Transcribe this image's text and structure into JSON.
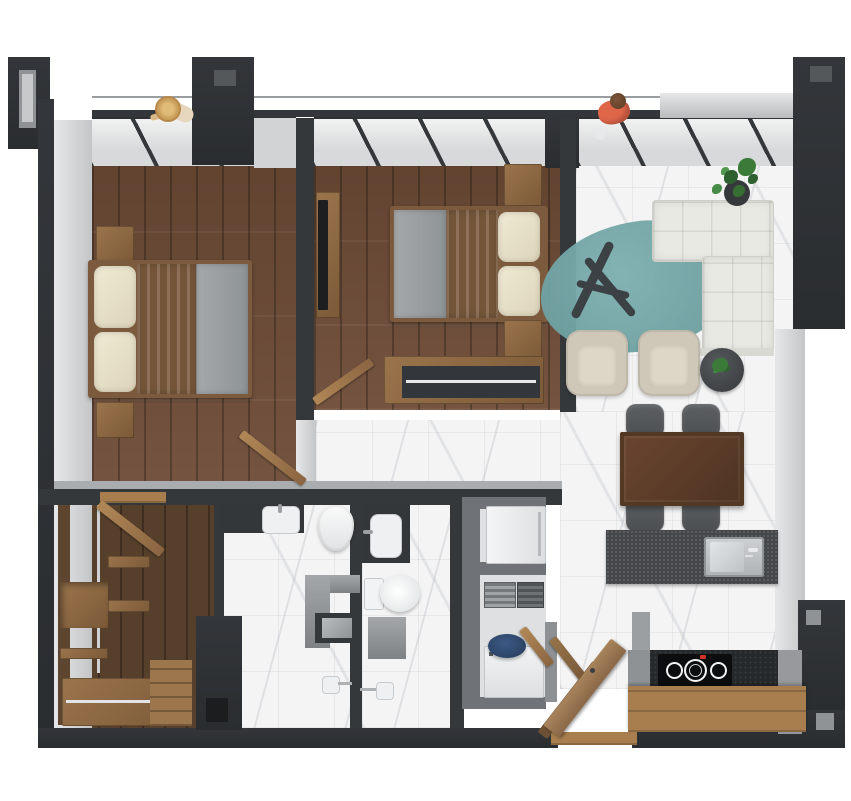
{
  "scene": {
    "title": "3D top-down floor plan render of a two-bedroom apartment",
    "view": "top-down axonometric render",
    "background": "#ffffff"
  },
  "palette": {
    "wall_dark": "#2e3134",
    "wall_interior": "#35383b",
    "wall_face_gray": "#c3c5c7",
    "wood_floor": "#6d4b36",
    "wood_furniture": "#9a744c",
    "marble_tile": "#f4f4f5",
    "sofa_white": "#e9e9e4",
    "rug_teal": "#6fa2a4",
    "blanket_blue": "#8ba0b2",
    "pillow_cream": "#ece5cf",
    "mattress_gray": "#9aa0a2",
    "dining_table_wood": "#5b3d2a",
    "chair_gray": "#55585b",
    "island_counter": "#45484b",
    "steel_sink": "#c0c4c6",
    "cooktop_black": "#0c0d0e",
    "cooktop_indicator_red": "#d23327",
    "appliance_white": "#eef0f1",
    "washer_basket_blue": "#31486b",
    "plant_green": "#3c7a3a",
    "person_shirt_orange": "#e0664a",
    "person_hat_straw": "#caa05c"
  },
  "rooms": [
    {
      "name": "bedroom-1",
      "floor": "wood planks"
    },
    {
      "name": "bedroom-2",
      "floor": "wood planks"
    },
    {
      "name": "living-dining-room",
      "floor": "white marble tile"
    },
    {
      "name": "kitchen",
      "floor": "white marble tile"
    },
    {
      "name": "bathroom-1",
      "floor": "white marble tile"
    },
    {
      "name": "bathroom-2",
      "floor": "white marble tile"
    },
    {
      "name": "walk-in-closet",
      "floor": "wood planks"
    },
    {
      "name": "utility-laundry-closet",
      "floor": "gray tile"
    },
    {
      "name": "hallway-lobby",
      "floor": "wood and marble"
    },
    {
      "name": "balcony-terrace",
      "floor": "open, glazed wall with railing"
    }
  ],
  "furniture": {
    "bedroom1": [
      "double-bed with cream pillows and blue throw",
      "nightstand upper",
      "nightstand lower",
      "swing door"
    ],
    "bedroom2": [
      "double-bed with cream pillows and blue throw",
      "tv-panel with wall tv",
      "nightstand upper",
      "nightstand lower",
      "dresser with open shelf",
      "swing door"
    ],
    "living": [
      "l-shaped white tufted sofa",
      "teal pebble rug",
      "driftwood coffee-table sculpture",
      "two cream armchairs",
      "round side table with plant",
      "potted plant in corner",
      "dining table dark wood",
      "four gray dining chairs"
    ],
    "kitchen": [
      "island with stainless sink",
      "wood worktop counter",
      "induction cooktop with four burners",
      "dark tile backsplash"
    ],
    "bathroom1": [
      "vanity sink on dark counter",
      "toilet",
      "shower with head",
      "storage niche partition"
    ],
    "bathroom2": [
      "vanity sink on dark counter",
      "toilet with tank",
      "shower with head",
      "low partition"
    ],
    "closet": [
      "wood shelving units",
      "hanging rails",
      "drawer cabinets",
      "swing door"
    ],
    "utility": [
      "refrigerator",
      "hvac vents",
      "washing machine with blue basket",
      "folding wood doors"
    ],
    "entry": [
      "entrance swing door",
      "wood threshold"
    ]
  },
  "people": [
    {
      "name": "person-balcony-left",
      "detail": "seen from above wearing straw hat, leaning on railing"
    },
    {
      "name": "person-balcony-right",
      "detail": "seen from above wearing orange shirt, walking on terrace"
    }
  ]
}
